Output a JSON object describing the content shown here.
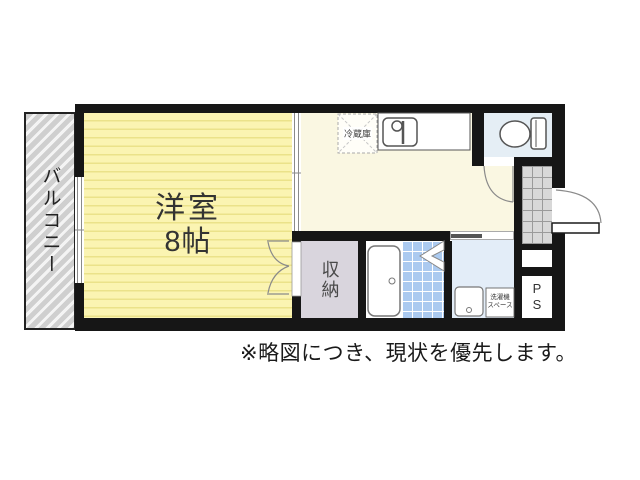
{
  "plan": {
    "balcony": {
      "label": "バルコニー"
    },
    "main_room": {
      "name": "洋室",
      "size": "8帖"
    },
    "kitchen": {
      "refrigerator_label": "冷蔵庫"
    },
    "closet": {
      "label": "収納"
    },
    "washroom": {
      "washer_space_line1": "洗濯機",
      "washer_space_line2": "スペース"
    },
    "pipe_space": {
      "label": "PS"
    }
  },
  "note": "※略図につき、現状を優先します。",
  "colors": {
    "wall": "#161616",
    "room_yellow": "#fbf4b2",
    "room_stripe": "#ebe28a",
    "kitchen_cream": "#faf7e2",
    "closet_gray": "#d9d5dd",
    "bath_tile_blue": "#abcaf0",
    "washroom_blue": "#e3edf8",
    "toilet_blue": "#e5eef5",
    "balcony_gray": "#cfcfcf",
    "genkan_tile": "#d8d8d8"
  }
}
